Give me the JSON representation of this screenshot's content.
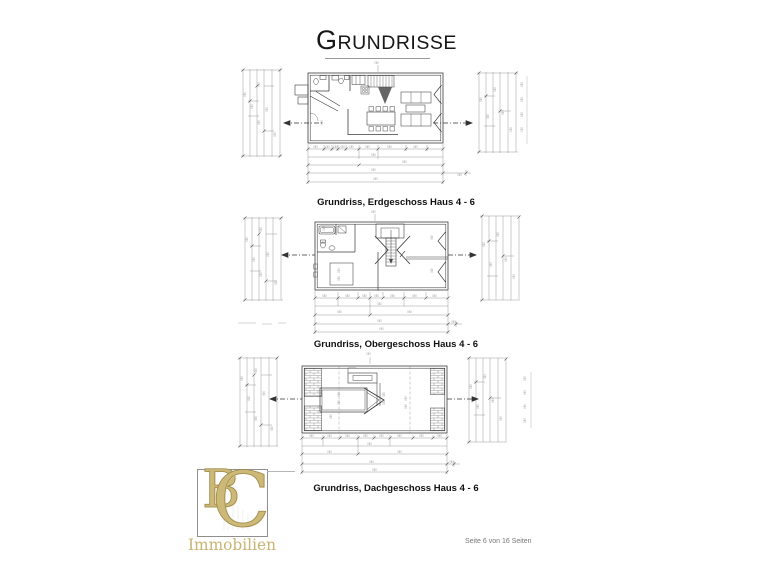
{
  "page": {
    "title": "Grundrisse",
    "title_initial": "G",
    "title_rest": "RUNDRISSE"
  },
  "plans": [
    {
      "id": "erdgeschoss",
      "caption": "Grundriss, Erdgeschoss  Haus 4 - 6"
    },
    {
      "id": "obergeschoss",
      "caption": "Grundriss, Obergeschoss Haus 4 - 6"
    },
    {
      "id": "dachgeschoss",
      "caption": "Grundriss, Dachgeschoss Haus 4 - 6"
    }
  ],
  "logo": {
    "letter_b": "B",
    "letter_c": "C",
    "subtitle": "Immobilien",
    "gold_color": "#c4ad67"
  },
  "footer": {
    "text": "Seite 6 von 16 Seiten"
  }
}
